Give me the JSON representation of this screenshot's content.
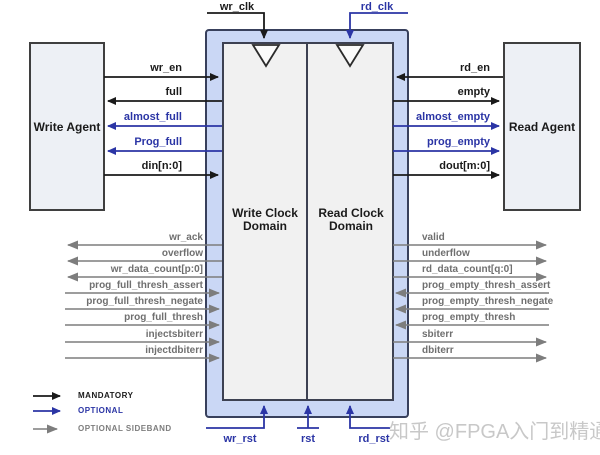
{
  "diagram": {
    "title_hint": "FIFO Generator block diagram",
    "left_agent_label": "Write Agent",
    "right_agent_label": "Read Agent",
    "write_domain_label": "Write Clock Domain",
    "read_domain_label": "Read Clock Domain",
    "clocks": {
      "wr_clk": "wr_clk",
      "rd_clk": "rd_clk"
    },
    "resets": {
      "wr_rst": "wr_rst",
      "rst": "rst",
      "rd_rst": "rd_rst"
    },
    "left_main_signals": [
      {
        "label": "wr_en",
        "type": "mandatory",
        "direction": "into-fifo"
      },
      {
        "label": "full",
        "type": "mandatory",
        "direction": "out-of-fifo"
      },
      {
        "label": "almost_full",
        "type": "optional",
        "direction": "out-of-fifo"
      },
      {
        "label": "Prog_full",
        "type": "optional",
        "direction": "out-of-fifo"
      },
      {
        "label": "din[n:0]",
        "type": "mandatory",
        "direction": "into-fifo"
      }
    ],
    "right_main_signals": [
      {
        "label": "rd_en",
        "type": "mandatory",
        "direction": "into-fifo"
      },
      {
        "label": "empty",
        "type": "mandatory",
        "direction": "out-of-fifo"
      },
      {
        "label": "almost_empty",
        "type": "optional",
        "direction": "out-of-fifo"
      },
      {
        "label": "prog_empty",
        "type": "optional",
        "direction": "out-of-fifo"
      },
      {
        "label": "dout[m:0]",
        "type": "mandatory",
        "direction": "out-of-fifo"
      }
    ],
    "left_sideband_signals": [
      {
        "label": "wr_ack",
        "direction": "out-of-fifo"
      },
      {
        "label": "overflow",
        "direction": "out-of-fifo"
      },
      {
        "label": "wr_data_count[p:0]",
        "direction": "out-of-fifo"
      },
      {
        "label": "prog_full_thresh_assert",
        "direction": "into-fifo"
      },
      {
        "label": "prog_full_thresh_negate",
        "direction": "into-fifo"
      },
      {
        "label": "prog_full_thresh",
        "direction": "into-fifo"
      },
      {
        "label": "injectsbiterr",
        "direction": "into-fifo"
      },
      {
        "label": "injectdbiterr",
        "direction": "into-fifo"
      }
    ],
    "right_sideband_signals": [
      {
        "label": "valid",
        "direction": "out-of-fifo"
      },
      {
        "label": "underflow",
        "direction": "out-of-fifo"
      },
      {
        "label": "rd_data_count[q:0]",
        "direction": "out-of-fifo"
      },
      {
        "label": "prog_empty_thresh_assert",
        "direction": "into-fifo"
      },
      {
        "label": "prog_empty_thresh_negate",
        "direction": "into-fifo"
      },
      {
        "label": "prog_empty_thresh",
        "direction": "into-fifo"
      },
      {
        "label": "sbiterr",
        "direction": "out-of-fifo"
      },
      {
        "label": "dbiterr",
        "direction": "out-of-fifo"
      }
    ],
    "legend": [
      {
        "label": "MANDATORY",
        "color": "#1a1a1a"
      },
      {
        "label": "OPTIONAL",
        "color": "#2b35a5"
      },
      {
        "label": "OPTIONAL SIDEBAND",
        "color": "#7d7d7d"
      }
    ],
    "watermark": "知乎 @FPGA入门到精通",
    "colors": {
      "mandatory": "#1a1a1a",
      "optional": "#2b35a5",
      "sideband": "#7d7d7d",
      "fifo_fill": "#cad7f5",
      "fifo_border": "#38405c",
      "inner_fill": "#f1f1f1"
    }
  }
}
